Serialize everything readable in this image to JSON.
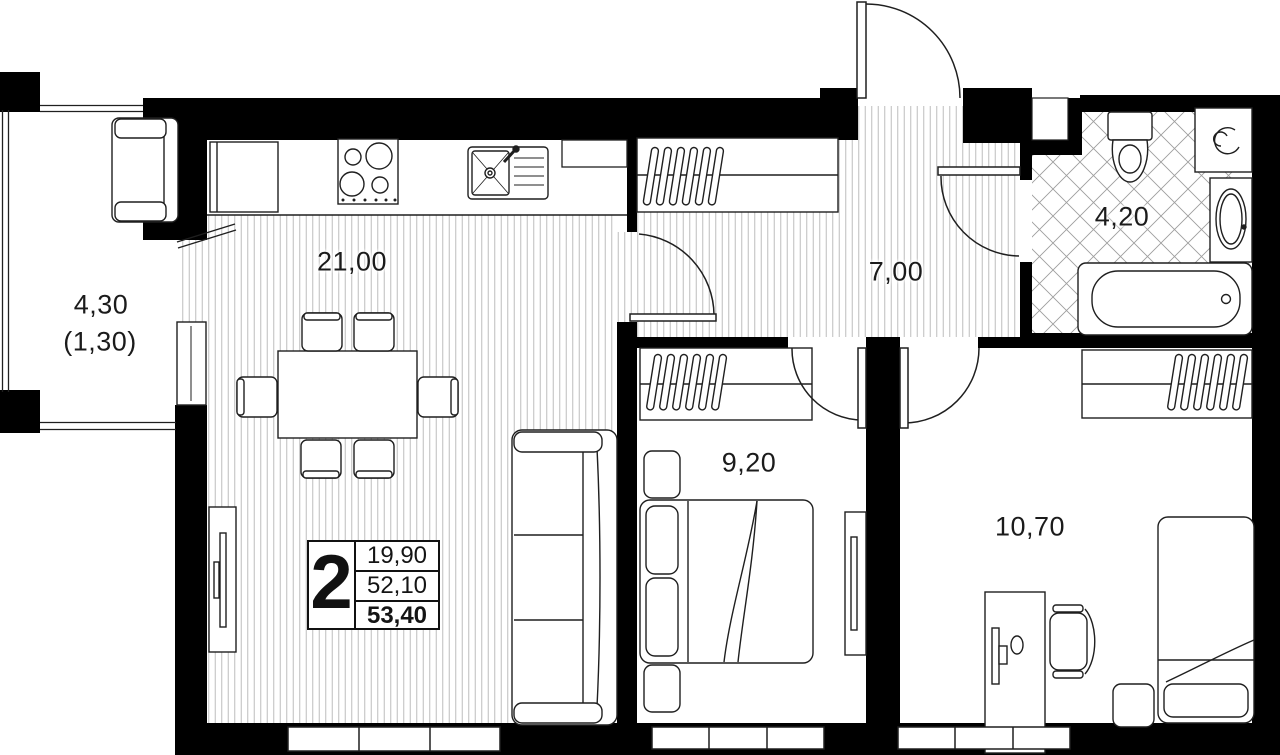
{
  "rooms": {
    "balcony": {
      "area": "4,30",
      "area_reduced": "(1,30)"
    },
    "kitchen_living": {
      "area": "21,00"
    },
    "hallway": {
      "area": "7,00"
    },
    "bathroom": {
      "area": "4,20"
    },
    "bedroom_1": {
      "area": "9,20"
    },
    "bedroom_2": {
      "area": "10,70"
    }
  },
  "stats": {
    "room_count": "2",
    "living_area": "19,90",
    "apartment_area": "52,10",
    "total_area": "53,40"
  },
  "colors": {
    "walls": "#000000",
    "floor_hatch": "#bdbdbd",
    "tile_hatch": "#9e9e9e",
    "outline": "#1f1f1f",
    "background": "#ffffff"
  },
  "furniture_icons": [
    "balcony-bench",
    "fridge",
    "stove",
    "kitchen-sink",
    "dining-table",
    "dining-chair",
    "tv-console",
    "sofa",
    "wardrobe",
    "coat-hanger",
    "entrance-door",
    "door-swing-arc",
    "toilet",
    "washing-machine",
    "wash-basin",
    "bathtub",
    "double-bed",
    "pillow",
    "nightstand",
    "mirror",
    "desk",
    "monitor",
    "desk-chair",
    "single-bed",
    "window"
  ]
}
